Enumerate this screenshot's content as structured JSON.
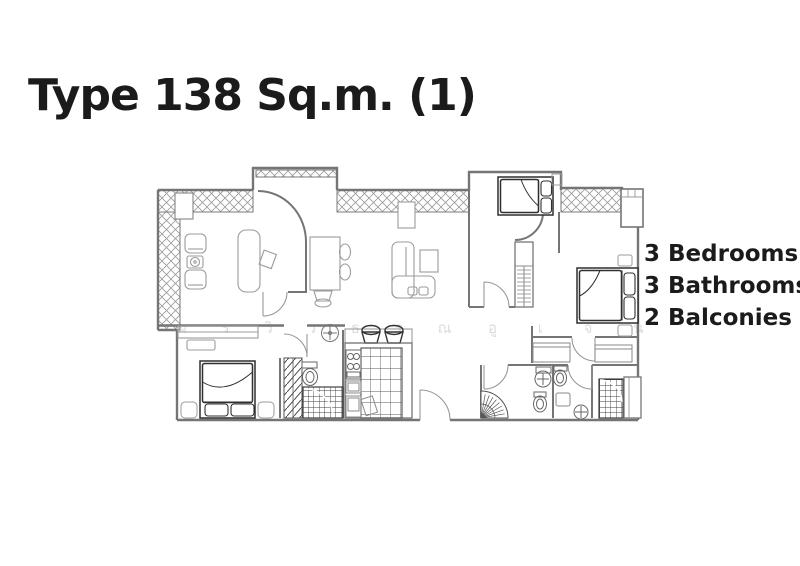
{
  "title": "Type 138 Sq.m. (1)",
  "features": [
    {
      "label": "3 Bedrooms"
    },
    {
      "label": "3 Bathrooms"
    },
    {
      "label": "2 Balconies"
    }
  ],
  "watermark": {
    "left_row": "ผ ร วิ ว ธ ร ณ",
    "right_row": "อู เ จ น"
  },
  "colors": {
    "text": "#1b1b1b",
    "wall_line": "#757575",
    "furniture_line": "#9b9b9b",
    "dark_furniture_line": "#2f2f2f",
    "hatch_line": "#9a9a9a",
    "watermark": "#dcdcdc",
    "background": "#ffffff"
  }
}
